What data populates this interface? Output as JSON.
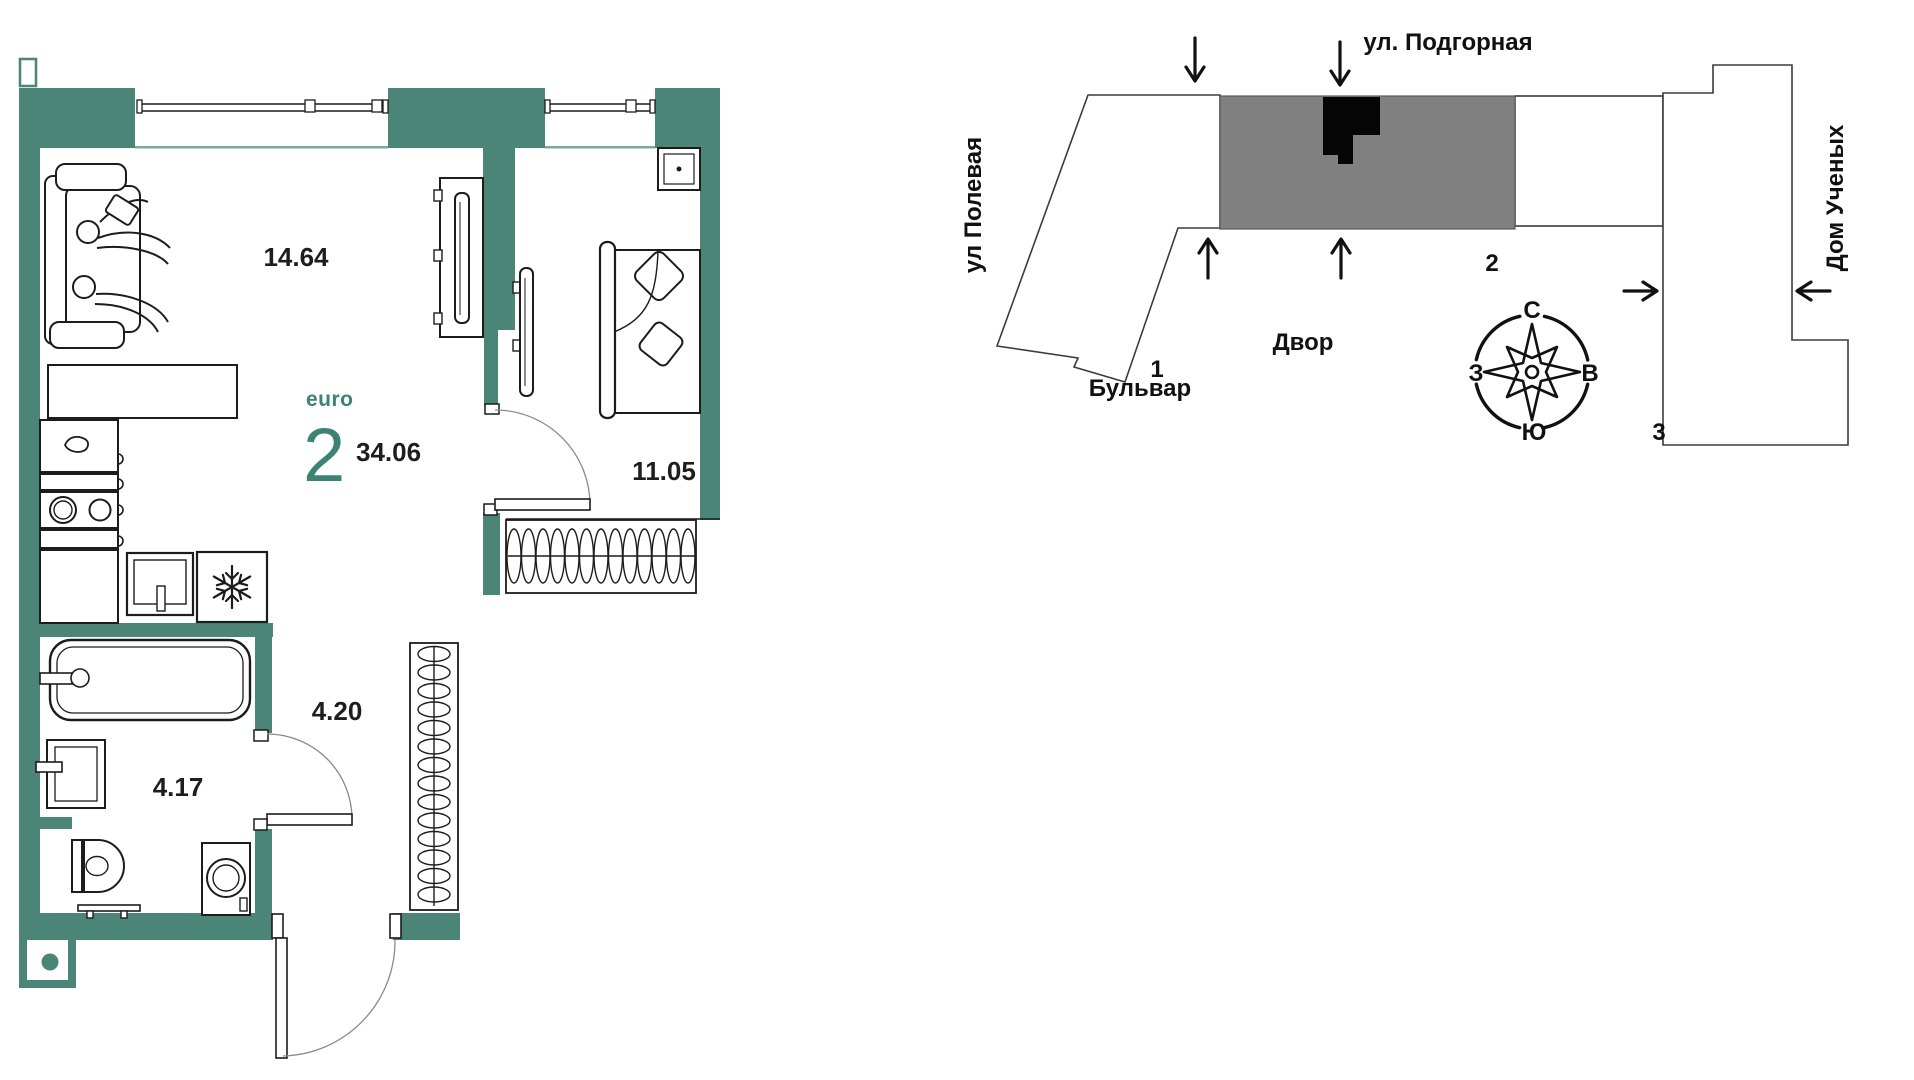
{
  "floor_plan": {
    "apartment": {
      "type_label": "euro",
      "rooms": "2",
      "total_area": "34.06"
    },
    "areas": {
      "living_room": "14.64",
      "bedroom": "11.05",
      "hallway": "4.20",
      "bathroom": "4.17"
    },
    "colors": {
      "wall": "#4B8577",
      "accent": "#3D8375",
      "outline": "#1C1C1C"
    }
  },
  "site_plan": {
    "street_top": "ул. Подгорная",
    "street_left": "ул Полевая",
    "building_right": "Дом Ученых",
    "courtyard_label": "Двор",
    "boulevard_label": "Бульвар",
    "building_numbers": {
      "b1": "1",
      "b2": "2",
      "b3": "3"
    },
    "compass": {
      "north": "С",
      "south": "Ю",
      "west": "З",
      "east": "В"
    },
    "colors": {
      "highlight_building": "#808080",
      "location_marker": "#000000"
    }
  }
}
